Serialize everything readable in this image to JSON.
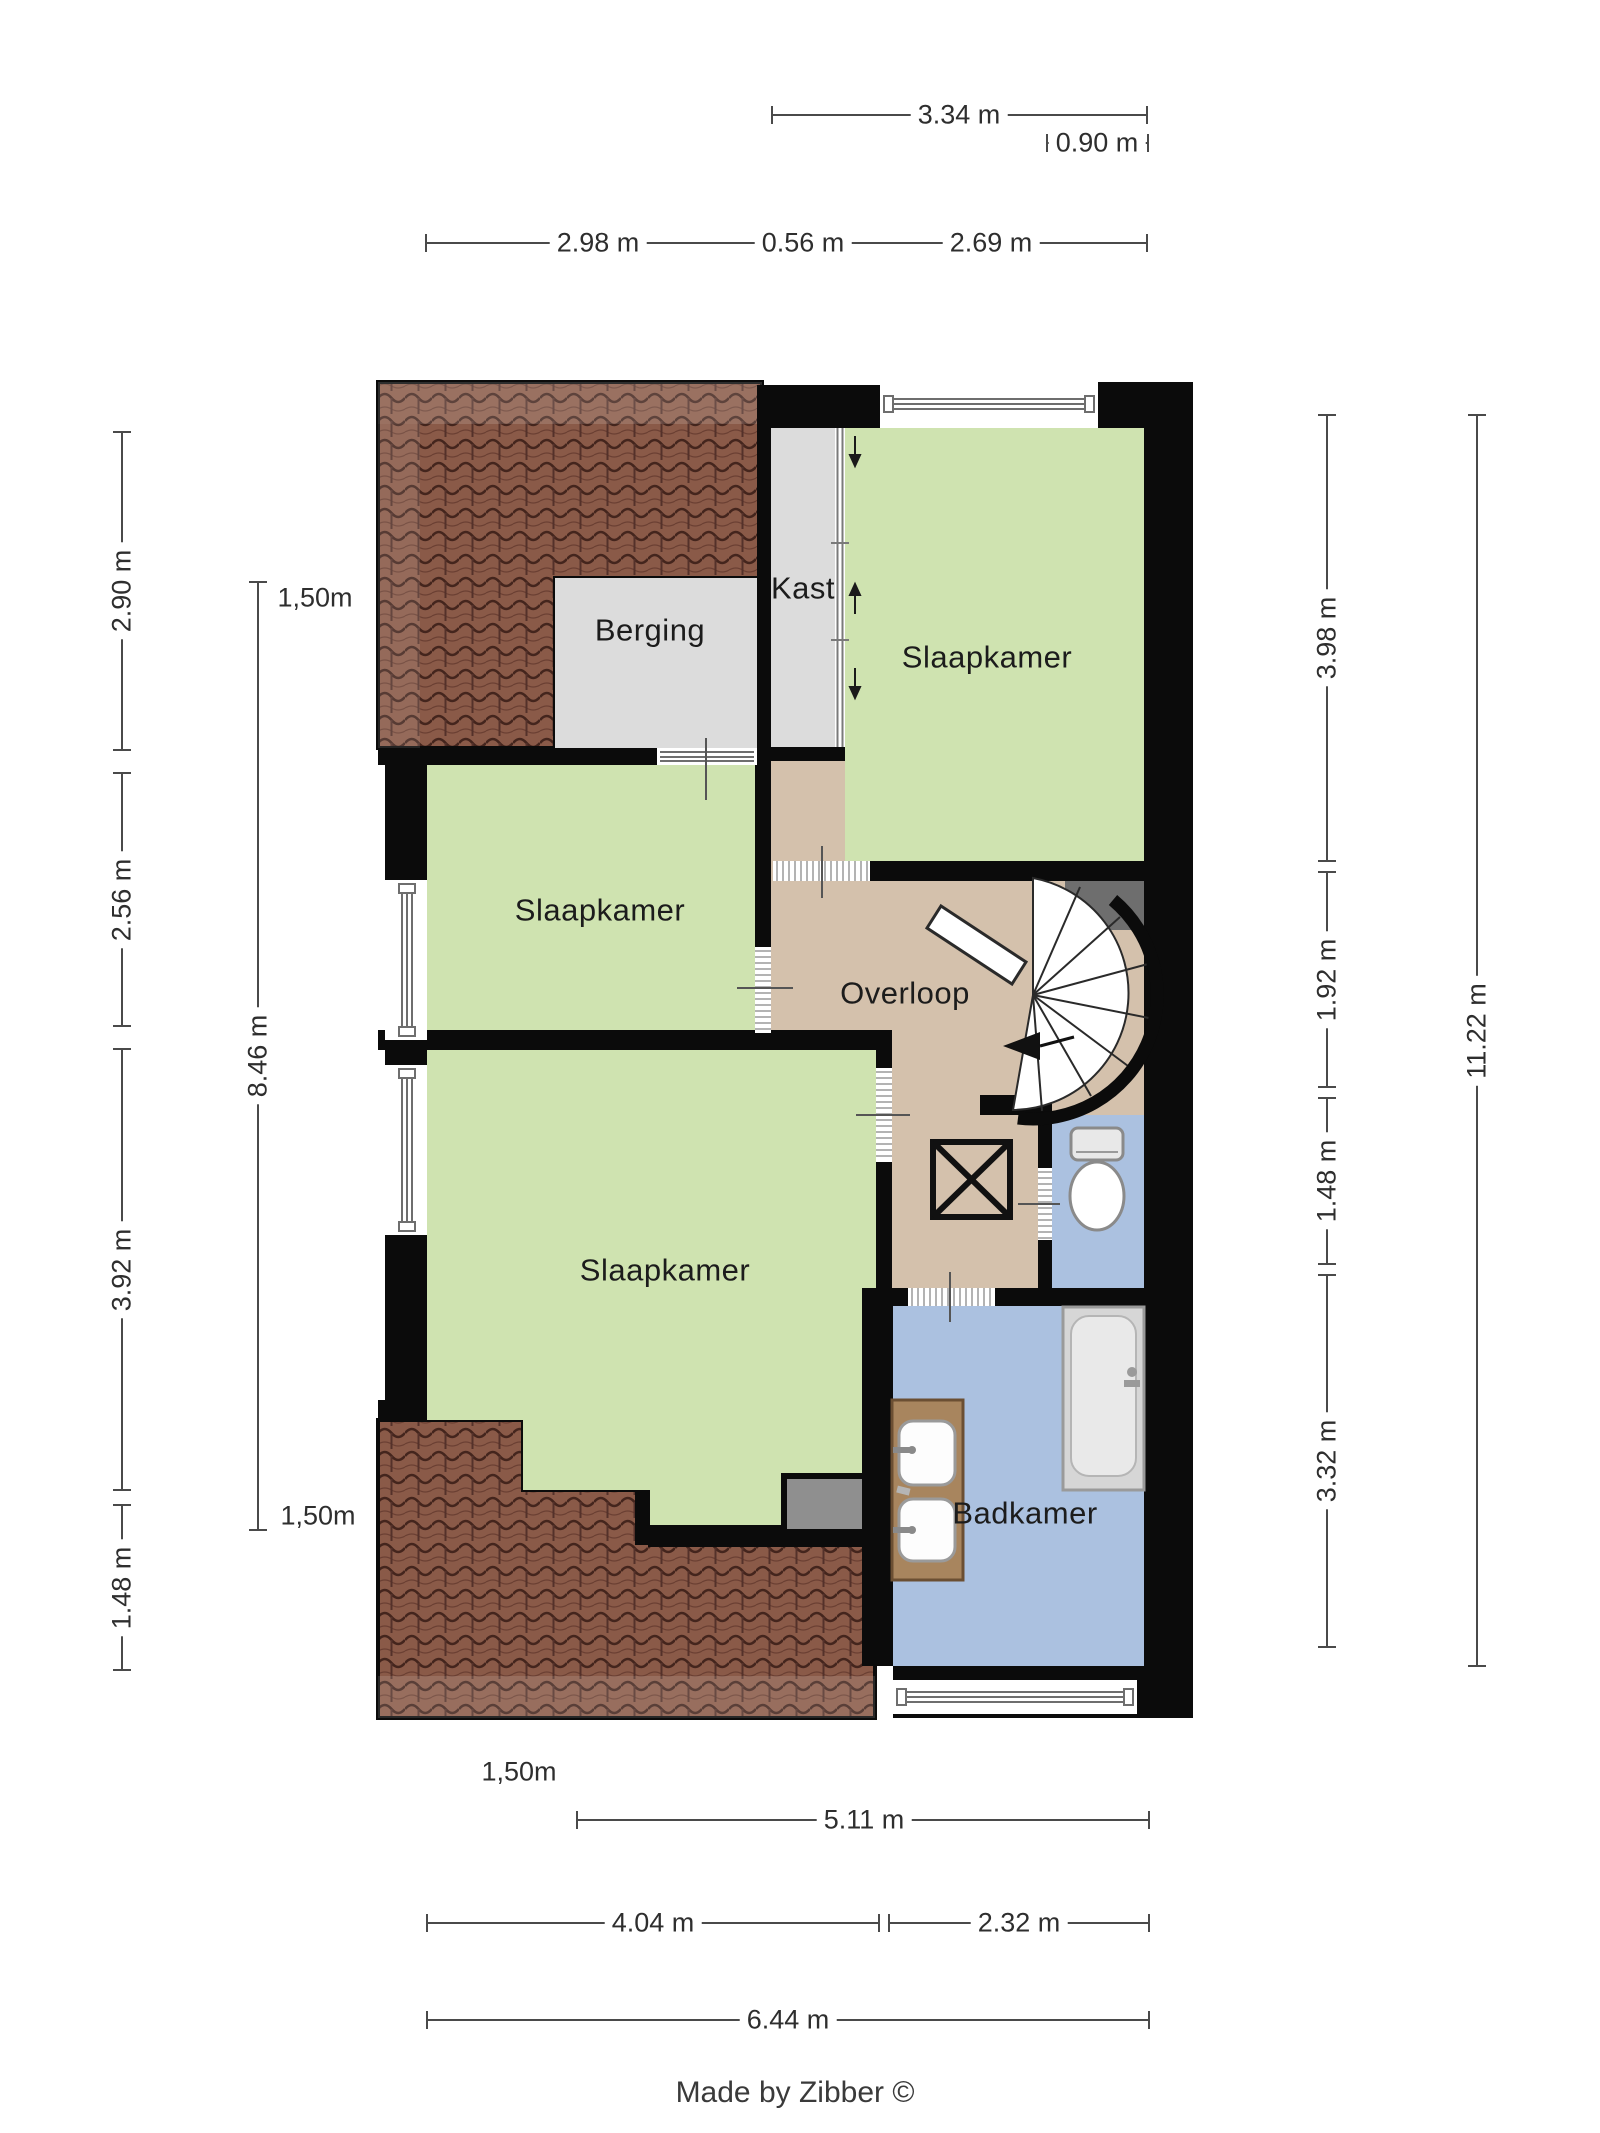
{
  "floorplan": {
    "title_hidden": "",
    "rooms": [
      {
        "id": "berging",
        "label": "Berging"
      },
      {
        "id": "kast",
        "label": "Kast"
      },
      {
        "id": "slaapkamer-top",
        "label": "Slaapkamer"
      },
      {
        "id": "slaapkamer-middle",
        "label": "Slaapkamer"
      },
      {
        "id": "overloop",
        "label": "Overloop"
      },
      {
        "id": "slaapkamer-bottom",
        "label": "Slaapkamer"
      },
      {
        "id": "badkamer",
        "label": "Badkamer"
      }
    ],
    "fixtures": [
      "spiral-staircase",
      "toilet",
      "bathtub",
      "double-sink-vanity",
      "shaft-cross-box",
      "sliding-closet-doors"
    ],
    "colors": {
      "wall": "#0b0b0b",
      "room_green": "#cfe3b0",
      "landing_tan": "#d4c1ac",
      "bathroom_blue": "#abc1e0",
      "storage_gray": "#dcdcdc",
      "roof_brown": "#8a5a48",
      "niche_gray": "#8f8f8f",
      "stair_pocket_gray": "#6e6e6e"
    }
  },
  "dimensions": {
    "top": [
      {
        "label": "3.34 m"
      },
      {
        "label": "0.90 m"
      },
      {
        "label": "2.98 m"
      },
      {
        "label": "0.56 m"
      },
      {
        "label": "2.69 m"
      }
    ],
    "left": [
      {
        "label": "2.90 m"
      },
      {
        "label": "2.56 m"
      },
      {
        "label": "3.92 m"
      },
      {
        "label": "1.48 m"
      },
      {
        "label": "8.46 m"
      }
    ],
    "right": [
      {
        "label": "3.98 m"
      },
      {
        "label": "1.92 m"
      },
      {
        "label": "1.48 m"
      },
      {
        "label": "3.32 m"
      },
      {
        "label": "11.22 m"
      }
    ],
    "bottom": [
      {
        "label": "1,50m"
      },
      {
        "label": "5.11 m"
      },
      {
        "label": "4.04 m"
      },
      {
        "label": "2.32 m"
      },
      {
        "label": "6.44 m"
      }
    ],
    "height_markers": [
      {
        "label": "1,50m"
      },
      {
        "label": "1,50m"
      }
    ]
  },
  "footer": {
    "credit": "Made by Zibber ©"
  }
}
